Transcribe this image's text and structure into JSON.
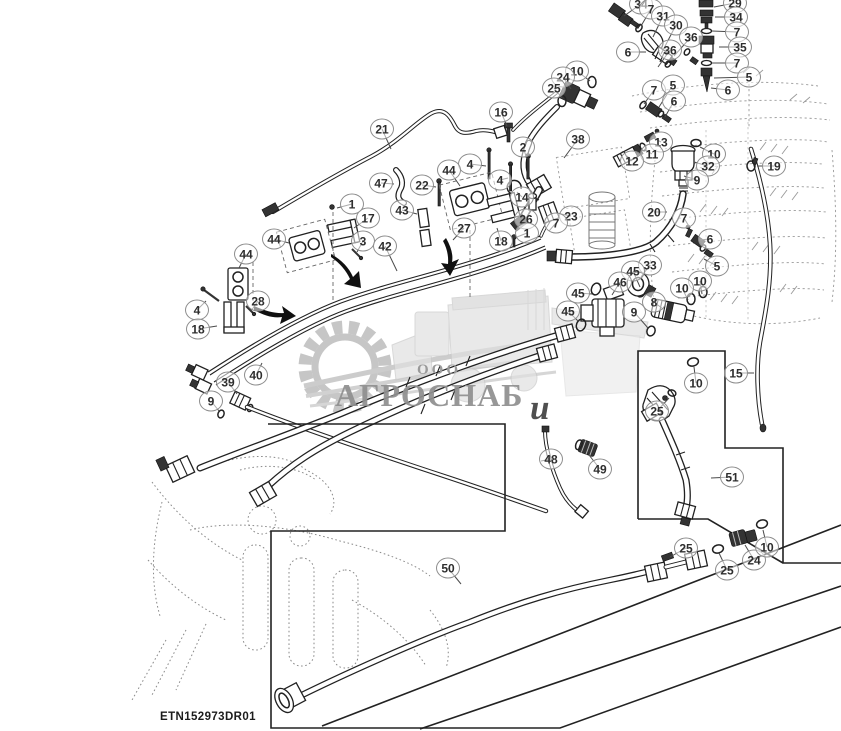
{
  "drawing_number": "ETN152973DR01",
  "watermark": {
    "company_prefix": "ООО",
    "company_name": "АГРОСНАБ",
    "overlay_letter": "и"
  },
  "colors": {
    "line_art": "#212121",
    "ghost_lines": "#9a9a9a",
    "callout_ring": "#8d8d8d",
    "callout_text": "#2e2e2e",
    "watermark_text": "#8f8f8f",
    "watermark_art": "#c3c3c3",
    "background": "#ffffff"
  },
  "callouts": [
    {
      "n": "6",
      "x": 628,
      "y": 52,
      "lx": 646,
      "ly": 52
    },
    {
      "n": "34",
      "x": 641,
      "y": 4,
      "lx": 624,
      "ly": 16
    },
    {
      "n": "7",
      "x": 651,
      "y": 9,
      "lx": 641,
      "ly": 26
    },
    {
      "n": "31",
      "x": 663,
      "y": 16,
      "lx": 653,
      "ly": 37
    },
    {
      "n": "30",
      "x": 676,
      "y": 25,
      "lx": 661,
      "ly": 54
    },
    {
      "n": "36",
      "x": 691,
      "y": 37,
      "lx": 674,
      "ly": 56
    },
    {
      "n": "36",
      "x": 670,
      "y": 50,
      "lx": 658,
      "ly": 67
    },
    {
      "n": "29",
      "x": 735,
      "y": 3,
      "lx": 714,
      "ly": 7
    },
    {
      "n": "34",
      "x": 736,
      "y": 17,
      "lx": 715,
      "ly": 17
    },
    {
      "n": "7",
      "x": 737,
      "y": 32,
      "lx": 712,
      "ly": 31
    },
    {
      "n": "35",
      "x": 740,
      "y": 47,
      "lx": 719,
      "ly": 47
    },
    {
      "n": "7",
      "x": 737,
      "y": 63,
      "lx": 712,
      "ly": 63
    },
    {
      "n": "5",
      "x": 749,
      "y": 77,
      "lx": 714,
      "ly": 78
    },
    {
      "n": "6",
      "x": 728,
      "y": 90,
      "lx": 711,
      "ly": 88
    },
    {
      "n": "10",
      "x": 577,
      "y": 71,
      "lx": 590,
      "ly": 81
    },
    {
      "n": "24",
      "x": 563,
      "y": 77,
      "lx": 571,
      "ly": 89
    },
    {
      "n": "25",
      "x": 554,
      "y": 88,
      "lx": 562,
      "ly": 98
    },
    {
      "n": "7",
      "x": 654,
      "y": 90,
      "lx": 644,
      "ly": 104
    },
    {
      "n": "5",
      "x": 673,
      "y": 85,
      "lx": 659,
      "ly": 107
    },
    {
      "n": "6",
      "x": 674,
      "y": 101,
      "lx": 665,
      "ly": 117
    },
    {
      "n": "38",
      "x": 578,
      "y": 139,
      "lx": 564,
      "ly": 158
    },
    {
      "n": "13",
      "x": 661,
      "y": 142,
      "lx": 650,
      "ly": 136
    },
    {
      "n": "11",
      "x": 652,
      "y": 154,
      "lx": 644,
      "ly": 149
    },
    {
      "n": "12",
      "x": 632,
      "y": 161,
      "lx": 627,
      "ly": 156
    },
    {
      "n": "10",
      "x": 714,
      "y": 154,
      "lx": 700,
      "ly": 147
    },
    {
      "n": "32",
      "x": 708,
      "y": 166,
      "lx": 694,
      "ly": 162
    },
    {
      "n": "9",
      "x": 697,
      "y": 180,
      "lx": 684,
      "ly": 176
    },
    {
      "n": "19",
      "x": 774,
      "y": 166,
      "lx": 757,
      "ly": 166
    },
    {
      "n": "20",
      "x": 654,
      "y": 212,
      "lx": 667,
      "ly": 212
    },
    {
      "n": "7",
      "x": 684,
      "y": 218,
      "lx": 690,
      "ly": 228
    },
    {
      "n": "6",
      "x": 710,
      "y": 239,
      "lx": 699,
      "ly": 240
    },
    {
      "n": "5",
      "x": 717,
      "y": 266,
      "lx": 704,
      "ly": 259
    },
    {
      "n": "33",
      "x": 650,
      "y": 265,
      "lx": 641,
      "ly": 277
    },
    {
      "n": "45",
      "x": 633,
      "y": 271,
      "lx": 640,
      "ly": 287
    },
    {
      "n": "46",
      "x": 620,
      "y": 282,
      "lx": 612,
      "ly": 295
    },
    {
      "n": "45",
      "x": 578,
      "y": 293,
      "lx": 592,
      "ly": 294
    },
    {
      "n": "45",
      "x": 568,
      "y": 311,
      "lx": 579,
      "ly": 322
    },
    {
      "n": "10",
      "x": 700,
      "y": 281,
      "lx": 702,
      "ly": 294
    },
    {
      "n": "10",
      "x": 682,
      "y": 288,
      "lx": 688,
      "ly": 300
    },
    {
      "n": "8",
      "x": 654,
      "y": 302,
      "lx": 663,
      "ly": 309
    },
    {
      "n": "9",
      "x": 634,
      "y": 312,
      "lx": 648,
      "ly": 328
    },
    {
      "n": "23",
      "x": 571,
      "y": 216,
      "lx": 556,
      "ly": 213
    },
    {
      "n": "7",
      "x": 556,
      "y": 223,
      "lx": 549,
      "ly": 231
    },
    {
      "n": "16",
      "x": 501,
      "y": 112,
      "lx": 507,
      "ly": 126
    },
    {
      "n": "21",
      "x": 382,
      "y": 129,
      "lx": 391,
      "ly": 149
    },
    {
      "n": "2",
      "x": 523,
      "y": 147,
      "lx": 527,
      "ly": 159
    },
    {
      "n": "4",
      "x": 470,
      "y": 164,
      "lx": 486,
      "ly": 166
    },
    {
      "n": "4",
      "x": 500,
      "y": 180,
      "lx": 508,
      "ly": 178
    },
    {
      "n": "44",
      "x": 449,
      "y": 170,
      "lx": 460,
      "ly": 186
    },
    {
      "n": "47",
      "x": 381,
      "y": 183,
      "lx": 394,
      "ly": 184
    },
    {
      "n": "22",
      "x": 422,
      "y": 185,
      "lx": 436,
      "ly": 187
    },
    {
      "n": "14",
      "x": 522,
      "y": 197,
      "lx": 517,
      "ly": 192
    },
    {
      "n": "43",
      "x": 402,
      "y": 210,
      "lx": 417,
      "ly": 214
    },
    {
      "n": "17",
      "x": 368,
      "y": 218,
      "lx": 354,
      "ly": 228
    },
    {
      "n": "26",
      "x": 526,
      "y": 219,
      "lx": 531,
      "ly": 209
    },
    {
      "n": "1",
      "x": 352,
      "y": 204,
      "lx": 337,
      "ly": 208
    },
    {
      "n": "1",
      "x": 527,
      "y": 233,
      "lx": 517,
      "ly": 237
    },
    {
      "n": "3",
      "x": 363,
      "y": 241,
      "lx": 357,
      "ly": 252
    },
    {
      "n": "27",
      "x": 464,
      "y": 228,
      "lx": 453,
      "ly": 240
    },
    {
      "n": "18",
      "x": 501,
      "y": 241,
      "lx": 497,
      "ly": 228
    },
    {
      "n": "42",
      "x": 385,
      "y": 246,
      "lx": 397,
      "ly": 271
    },
    {
      "n": "44",
      "x": 274,
      "y": 239,
      "lx": 289,
      "ly": 243
    },
    {
      "n": "44",
      "x": 246,
      "y": 254,
      "lx": 239,
      "ly": 268
    },
    {
      "n": "28",
      "x": 258,
      "y": 301,
      "lx": 251,
      "ly": 311
    },
    {
      "n": "4",
      "x": 197,
      "y": 310,
      "lx": 206,
      "ly": 301
    },
    {
      "n": "18",
      "x": 198,
      "y": 329,
      "lx": 217,
      "ly": 326
    },
    {
      "n": "40",
      "x": 256,
      "y": 375,
      "lx": 262,
      "ly": 363
    },
    {
      "n": "39",
      "x": 228,
      "y": 382,
      "lx": 237,
      "ly": 394
    },
    {
      "n": "9",
      "x": 211,
      "y": 401,
      "lx": 219,
      "ly": 411
    },
    {
      "n": "48",
      "x": 551,
      "y": 459,
      "lx": 541,
      "ly": 461
    },
    {
      "n": "49",
      "x": 600,
      "y": 469,
      "lx": 589,
      "ly": 455
    },
    {
      "n": "50",
      "x": 448,
      "y": 568,
      "lx": 461,
      "ly": 584
    },
    {
      "n": "15",
      "x": 736,
      "y": 373,
      "lx": 754,
      "ly": 373
    },
    {
      "n": "10",
      "x": 696,
      "y": 383,
      "lx": 694,
      "ly": 367
    },
    {
      "n": "25",
      "x": 657,
      "y": 411,
      "lx": 669,
      "ly": 398
    },
    {
      "n": "51",
      "x": 732,
      "y": 477,
      "lx": 711,
      "ly": 478
    },
    {
      "n": "25",
      "x": 686,
      "y": 548,
      "lx": 670,
      "ly": 557
    },
    {
      "n": "25",
      "x": 727,
      "y": 570,
      "lx": 719,
      "ly": 553
    },
    {
      "n": "24",
      "x": 754,
      "y": 560,
      "lx": 745,
      "ly": 545
    },
    {
      "n": "10",
      "x": 767,
      "y": 547,
      "lx": 763,
      "ly": 530
    }
  ]
}
